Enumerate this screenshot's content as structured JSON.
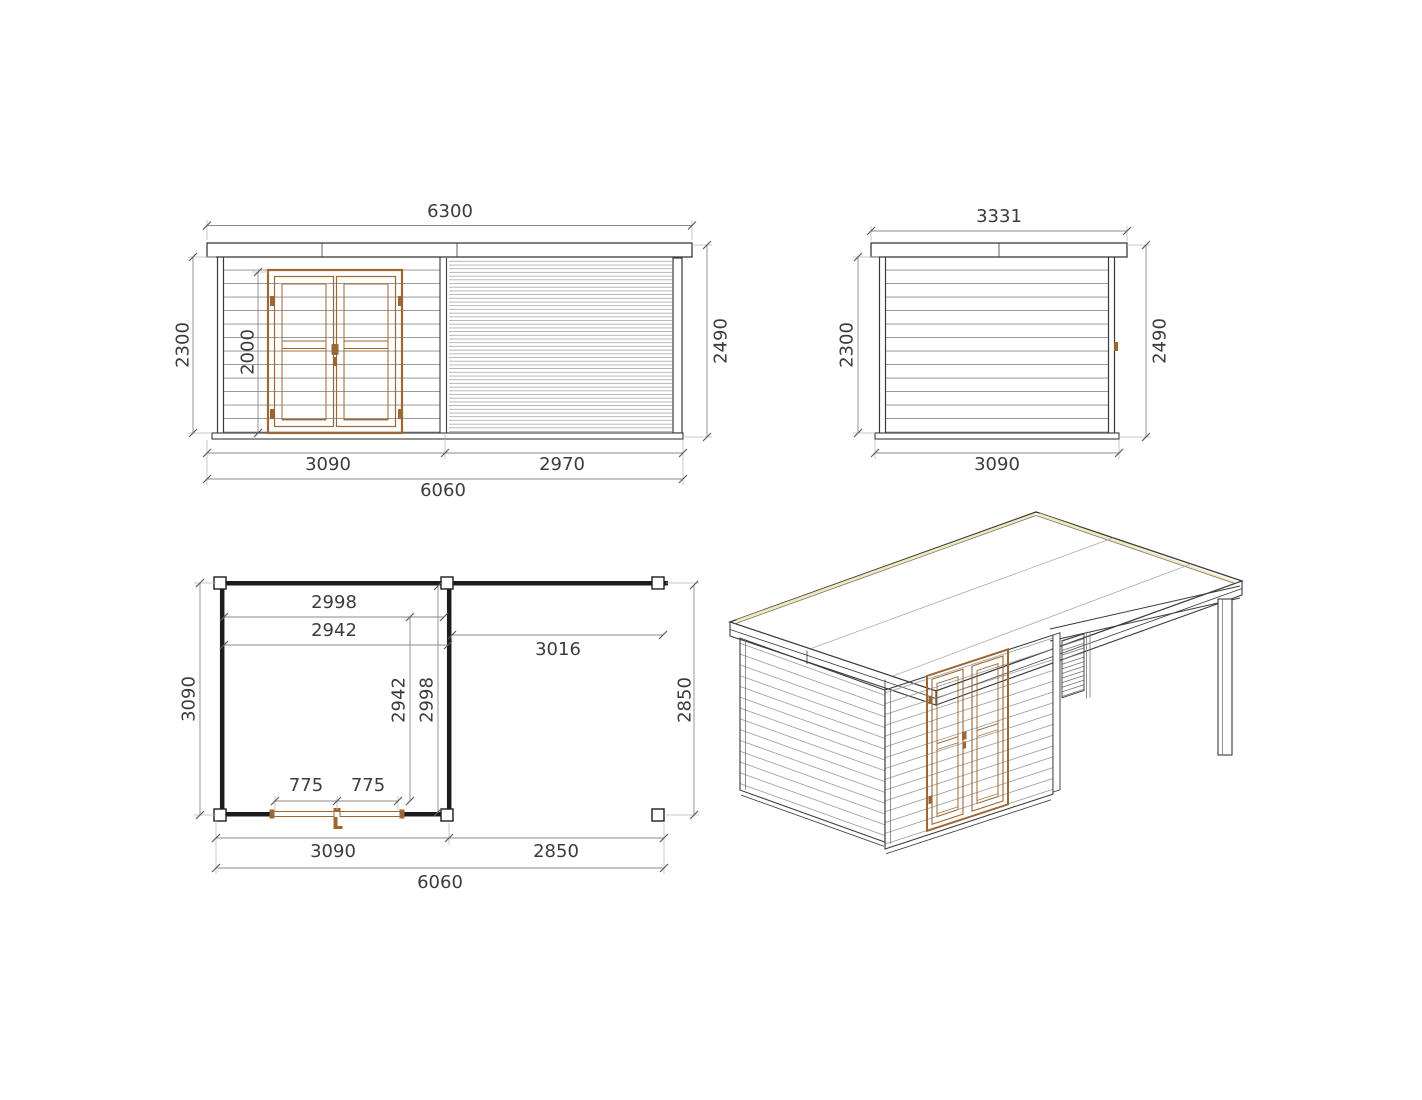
{
  "front_elevation": {
    "roof_width": "6300",
    "wall_height": "2300",
    "door_height": "2000",
    "overall_height": "2490",
    "cabin_width": "3090",
    "canopy_width": "2970",
    "total_width": "6060"
  },
  "side_elevation": {
    "roof_depth": "3331",
    "wall_height": "2300",
    "overall_height": "2490",
    "base_depth": "3090"
  },
  "floor_plan": {
    "interior_width_a": "2998",
    "interior_width_b": "2942",
    "canopy_clear_span": "3016",
    "side_depth": "3090",
    "interior_depth_a": "2942",
    "interior_depth_b": "2998",
    "canopy_depth": "2850",
    "door_leaf_left": "775",
    "door_leaf_right": "775",
    "cabin_width": "3090",
    "canopy_width": "2850",
    "total_width": "6060"
  },
  "colors": {
    "outline": "#3a3a3a",
    "dimension_line": "#8a8a8a",
    "text": "#3c3c3c",
    "wood": "#9c6732",
    "roof_highlight": "#efe8b8",
    "plan_wall": "#1c1c1c"
  }
}
